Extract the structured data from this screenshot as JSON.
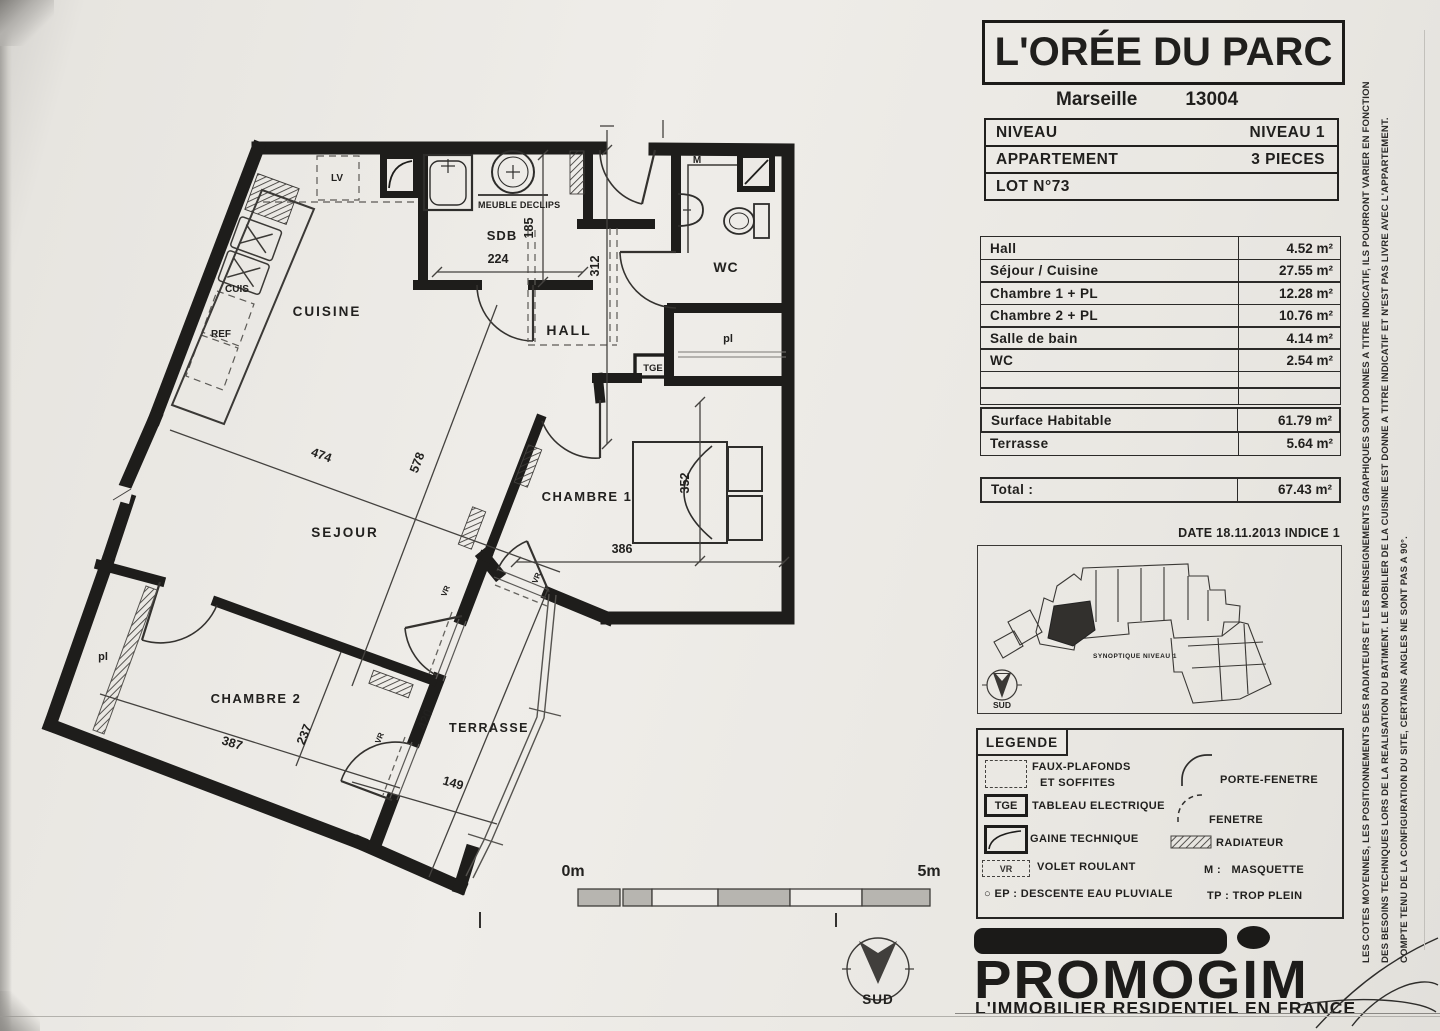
{
  "header": {
    "project": "L'ORÉE DU PARC",
    "city": "Marseille",
    "postal_code": "13004",
    "info_rows": [
      {
        "label": "NIVEAU",
        "value": "NIVEAU 1"
      },
      {
        "label": "APPARTEMENT",
        "value": "3 PIECES"
      },
      {
        "label": "LOT N°73",
        "value": ""
      }
    ]
  },
  "areas": {
    "rows": [
      {
        "label": "Hall",
        "value": "4.52 m²"
      },
      {
        "label": "Séjour / Cuisine",
        "value": "27.55 m²"
      },
      {
        "label": "Chambre 1 + PL",
        "value": "12.28 m²"
      },
      {
        "label": "Chambre 2 + PL",
        "value": "10.76 m²"
      },
      {
        "label": "Salle de bain",
        "value": "4.14 m²"
      },
      {
        "label": "WC",
        "value": "2.54 m²"
      }
    ],
    "summary": [
      {
        "label": "Surface Habitable",
        "value": "61.79 m²"
      },
      {
        "label": "Terrasse",
        "value": "5.64 m²"
      }
    ],
    "total": {
      "label": "Total :",
      "value": "67.43 m²"
    }
  },
  "date_line": "DATE 18.11.2013 INDICE 1",
  "synoptique": {
    "label": "SYNOPTIQUE NIVEAU 1",
    "compass": "SUD"
  },
  "legend": {
    "title": "LEGENDE",
    "left": [
      {
        "label": "FAUX-PLAFONDS",
        "label2": "ET SOFFITES"
      },
      {
        "symbol_text": "TGE",
        "label": "TABLEAU ELECTRIQUE"
      },
      {
        "label": "GAINE TECHNIQUE"
      },
      {
        "symbol_text": "VR",
        "label": "VOLET ROULANT"
      },
      {
        "prefix": "EP :",
        "label": "DESCENTE EAU PLUVIALE"
      }
    ],
    "right": [
      {
        "label": "PORTE-FENETRE"
      },
      {
        "label": "FENETRE"
      },
      {
        "label": "RADIATEUR"
      },
      {
        "prefix": "M :",
        "label": "MASQUETTE"
      },
      {
        "prefix": "TP :",
        "label": "TROP PLEIN"
      }
    ]
  },
  "footer": {
    "brand": "PROMOGIM",
    "tagline": "L'IMMOBILIER RESIDENTIEL EN FRANCE"
  },
  "disclaimer": {
    "line1": "LES COTES MOYENNES, LES POSITIONNEMENTS DES RADIATEURS ET LES RENSEIGNEMENTS GRAPHIQUES SONT DONNES A TITRE INDICATIF, ILS POURRONT VARIER EN FONCTION",
    "line2": "DES BESOINS TECHNIQUES LORS DE LA REALISATION DU BATIMENT. LE MOBILIER DE LA CUISINE EST DONNE A TITRE INDICATIF ET N'EST PAS LIVRE AVEC L'APPARTEMENT.",
    "line3": "COMPTE TENU DE LA CONFIGURATION DU SITE, CERTAINS ANGLES NE SONT PAS A 90°."
  },
  "plan": {
    "rooms": {
      "cuisine": "CUISINE",
      "sejour": "SEJOUR",
      "hall": "HALL",
      "sdb": "SDB",
      "wc": "WC",
      "chambre1": "CHAMBRE 1",
      "chambre2": "CHAMBRE 2",
      "terrasse": "TERRASSE"
    },
    "labels": {
      "lv": "LV",
      "cuis": "CUIS",
      "ref": "REF",
      "tge": "TGE",
      "m": "M",
      "pl": "pl",
      "vr": "VR",
      "meuble": "MEUBLE DECLIPS"
    },
    "dims": {
      "d185": "185",
      "d224": "224",
      "d312": "312",
      "d474": "474",
      "d578": "578",
      "d352": "352",
      "d386": "386",
      "d387": "387",
      "d237": "237",
      "d420": "420",
      "d149": "149"
    },
    "scale": {
      "start": "0m",
      "end": "5m"
    },
    "compass": "SUD"
  }
}
